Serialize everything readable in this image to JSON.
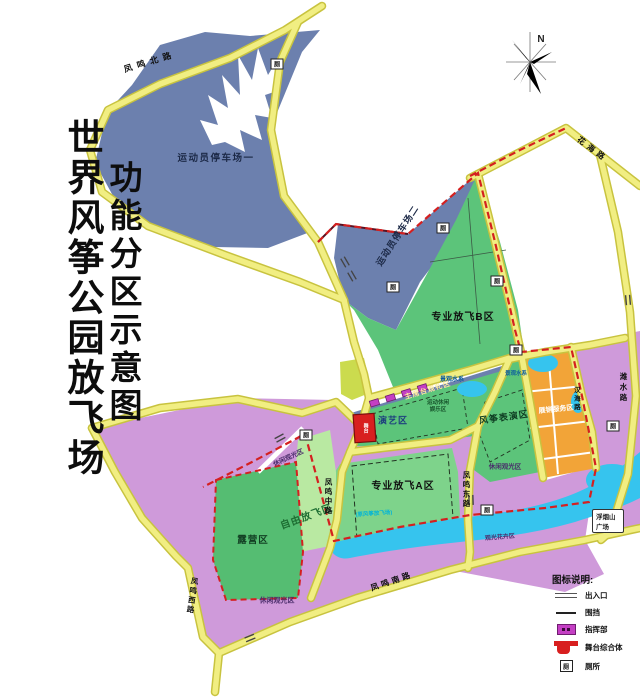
{
  "title": {
    "main": "世界风筝公园放飞场",
    "sub": "功能分区示意图"
  },
  "compass": {
    "north": "N"
  },
  "zones": {
    "parking1": "运动员停车场一",
    "parking2": "运动员停车场二",
    "pro_b": "专业放飞B区",
    "pro_a": "专业放飞A区",
    "free_fly": "自由放飞区",
    "camping": "露营区",
    "performance": "演艺区",
    "kite_show": "风筝表演区",
    "expo_service": "展销服务区",
    "leisure_1": "休闲观光区",
    "leisure_2": "休闲观光区",
    "leisure_3": "休闲观光区",
    "flower": "观光花卉区",
    "grandstand": "主席台观礼区",
    "athlete_rest_line1": "运动休闲",
    "athlete_rest_line2": "娱乐区",
    "water_label": "景观水系",
    "water_label2": "景观水系",
    "note_former": "(原风筝放飞场)",
    "stage": "舞台"
  },
  "roads": {
    "north": "凤鸣北路",
    "west": "凤鸣西路",
    "middle": "凤鸣中路",
    "east": "凤鸣东路",
    "south": "凤鸣南路",
    "huahai": "花海路",
    "hanhai": "汉海路",
    "weishui": "潍水路"
  },
  "badges": {
    "plaza": "浮烟山广场",
    "toilet": "厕"
  },
  "legend": {
    "title": "图标说明:",
    "items": [
      {
        "id": "entrance",
        "label": "出入口"
      },
      {
        "id": "fence",
        "label": "围挡"
      },
      {
        "id": "command",
        "label": "指挥部"
      },
      {
        "id": "stage-complex",
        "label": "舞台综合体"
      },
      {
        "id": "toilet",
        "label": "厕所"
      }
    ]
  },
  "colors": {
    "road_fill": "#f1ee82",
    "road_casing": "#c8c33f",
    "parking_blue": "#6c80ae",
    "green_zone": "#5cc47a",
    "green_light": "#b9e9a2",
    "green_a": "#7ed38b",
    "purple_zone": "#cf9ada",
    "orange_zone": "#f2a438",
    "water": "#36c4ee",
    "fence_red": "#d42020",
    "stage_red": "#d81f1f",
    "command_magenta": "#c43fc4",
    "yellow_green": "#cbdb4e"
  }
}
